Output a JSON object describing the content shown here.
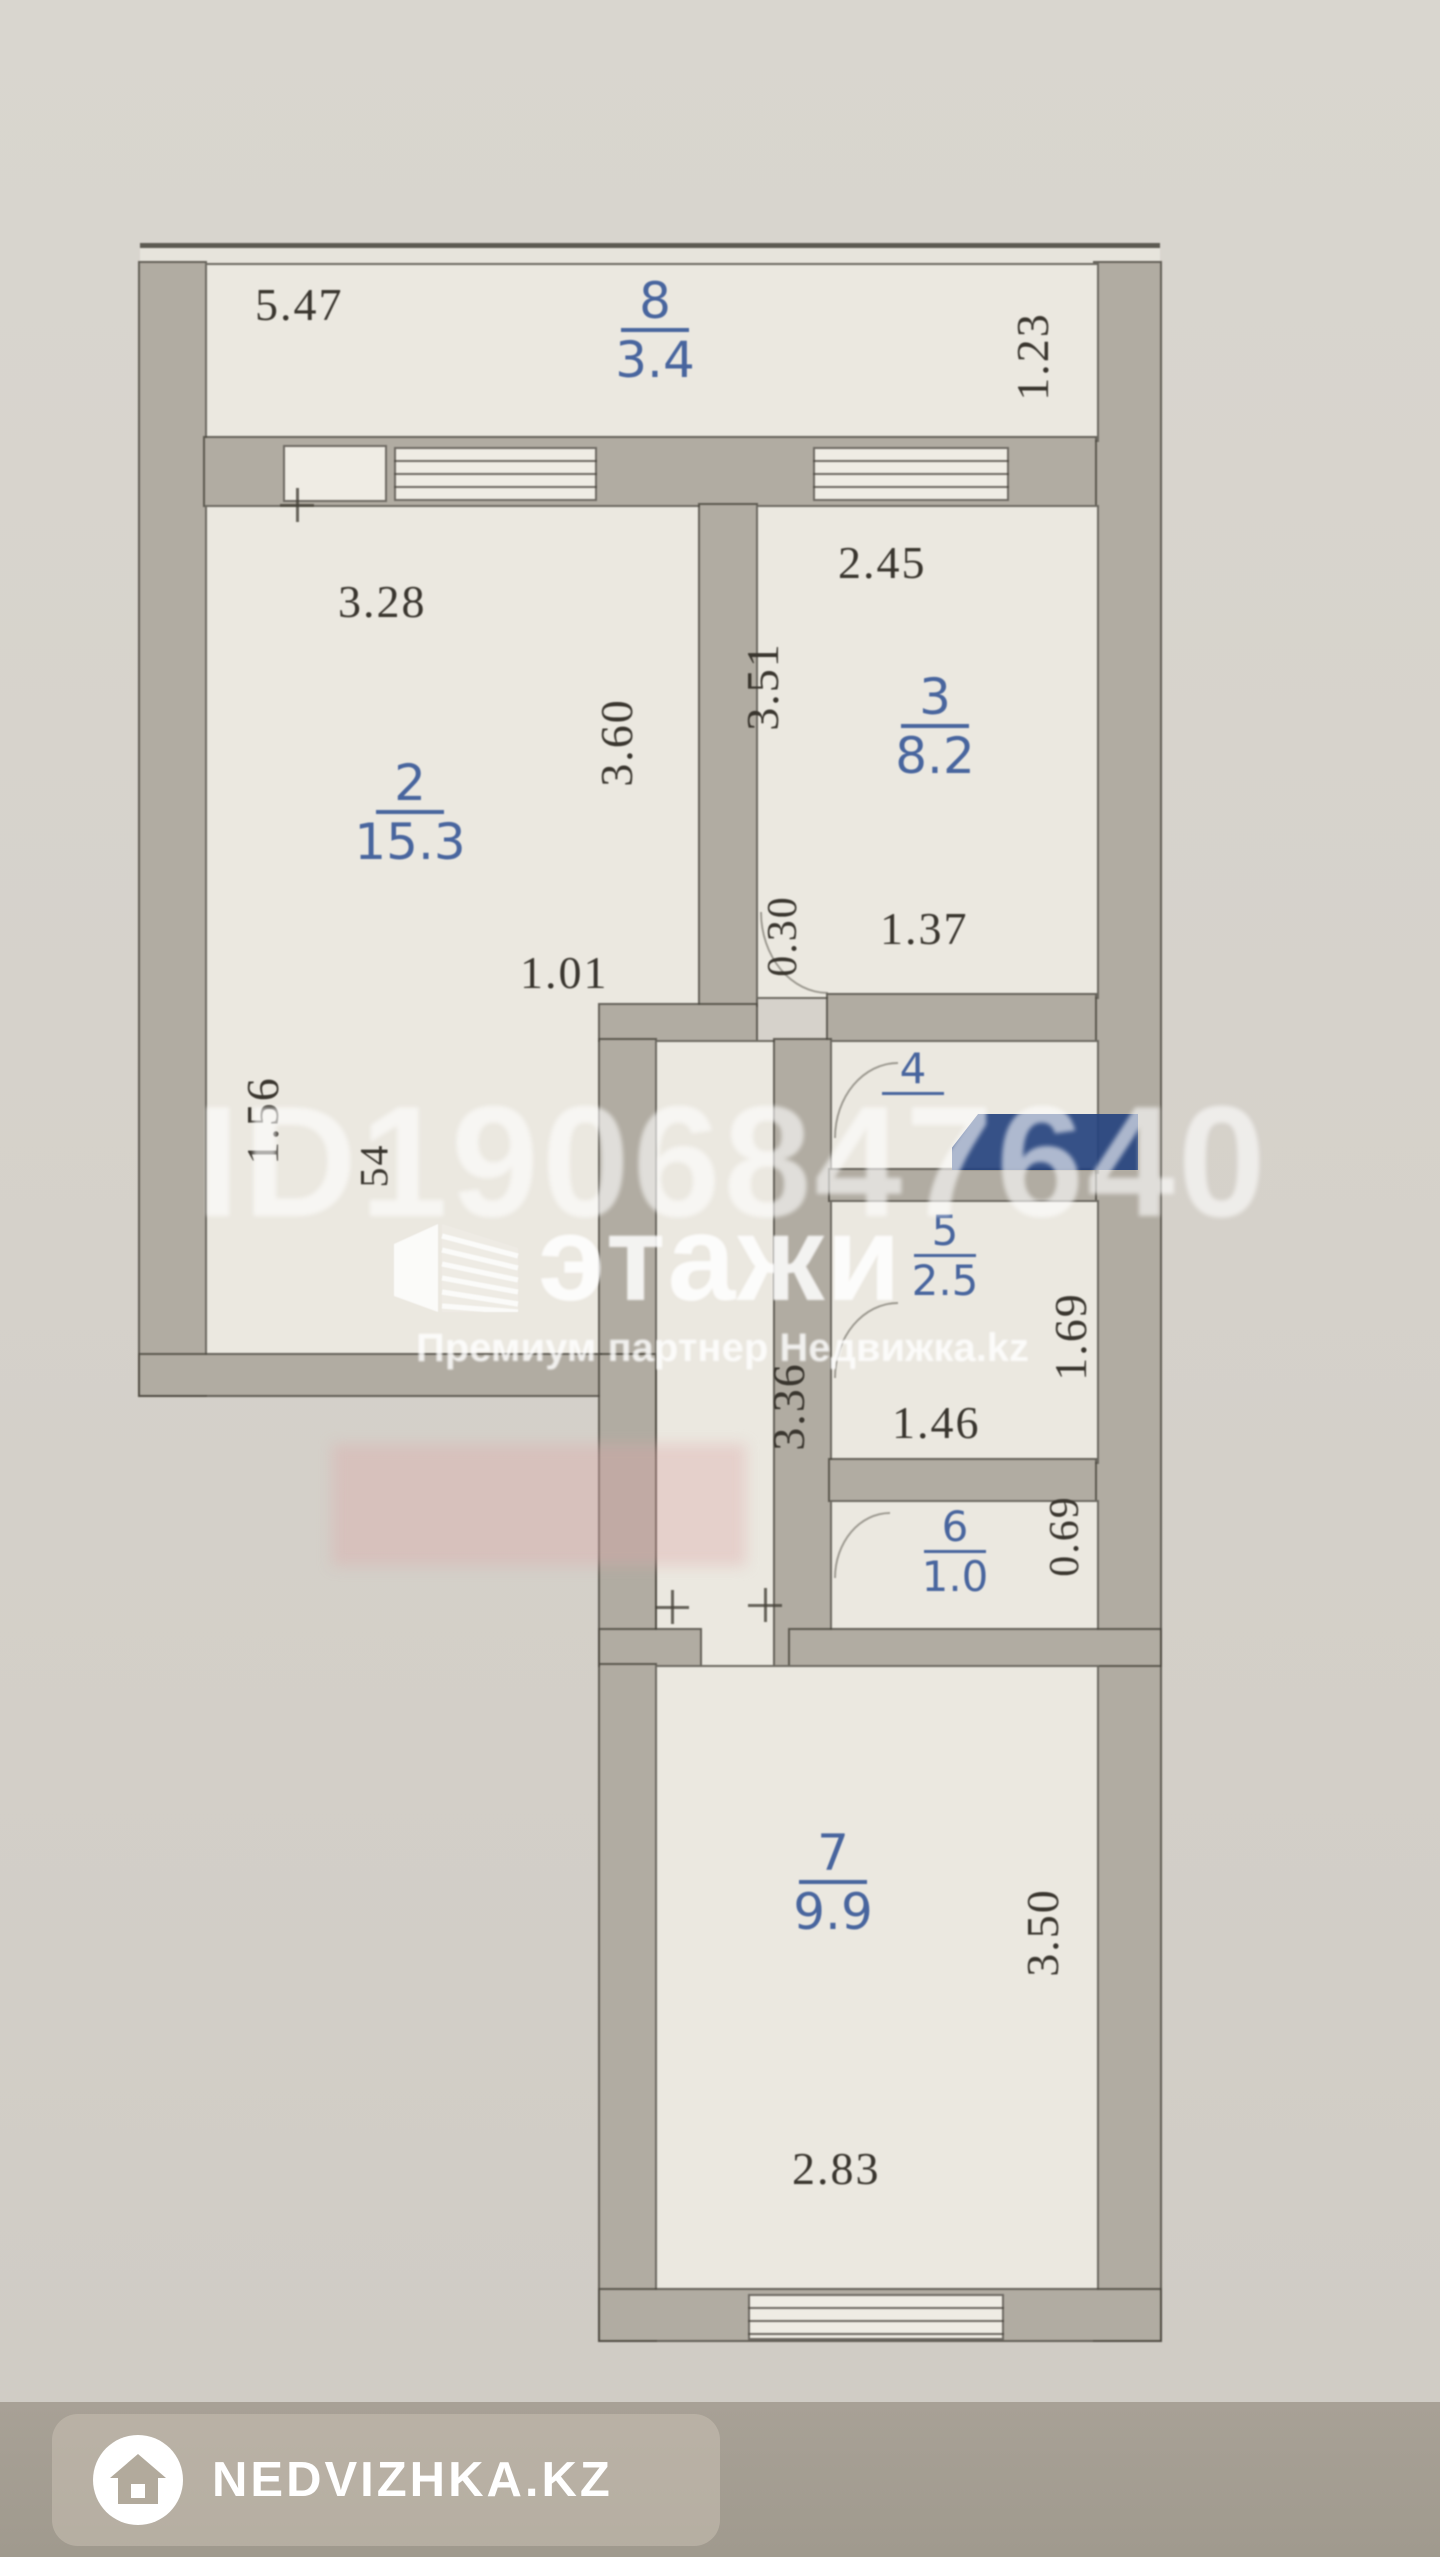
{
  "watermark": {
    "id_text": "ID1906847640",
    "logo_text": "этажи",
    "logo_subtitle": "Премиум партнер Недвижка.kz"
  },
  "footer": {
    "brand": "NEDVIZHKA.KZ"
  },
  "colors": {
    "paper": "#d6d2cb",
    "wall_fill": "#b1aca2",
    "room_fill": "#ebe8e0",
    "dim_text": "#39352e",
    "room_label_blue": "#48659e",
    "navy_stripe": "#26437f",
    "pink_stripe": "#dea8a8",
    "footer_bar": "#a49d92"
  },
  "rooms": {
    "r8": {
      "number": "8",
      "area": "3.4"
    },
    "r2": {
      "number": "2",
      "area": "15.3"
    },
    "r3": {
      "number": "3",
      "area": "8.2"
    },
    "r4": {
      "number": "4",
      "area": ""
    },
    "r5": {
      "number": "5",
      "area": "2.5"
    },
    "r6": {
      "number": "6",
      "area": "1.0"
    },
    "r7": {
      "number": "7",
      "area": "9.9"
    }
  },
  "dims": {
    "balcony_width": "5.47",
    "balcony_depth": "1.23",
    "r2_width": "3.28",
    "r2_height": "3.60",
    "r2_door": "1.01",
    "r2_seg_left": "1.56",
    "r2_seg_small": "54",
    "r3_width": "2.45",
    "r3_height": "3.51",
    "r3_bottom": "1.37",
    "r3_offset": "0.30",
    "hall_height": "3.36",
    "r5_width": "1.46",
    "r5_height": "1.69",
    "r6_height": "0.69",
    "r7_height": "3.50",
    "r7_width": "2.83"
  }
}
